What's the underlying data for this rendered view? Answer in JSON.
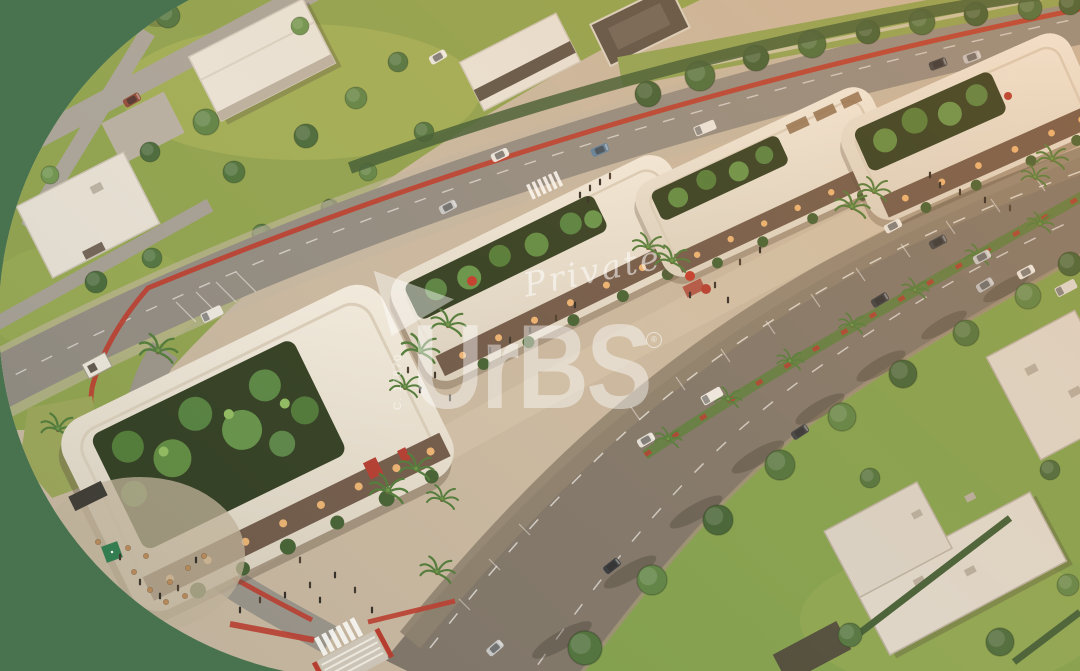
{
  "image_alt": "Aerial golden-hour 3D architectural rendering of an open-air retail strip with rooftop palm gardens and cafe terraces, flanked by tree-lined avenues with red bike lanes and a residential neighborhood, displayed inside a large rounded shape on a green background",
  "watermark": {
    "brand": "UrBS",
    "registered_mark": "®",
    "label_script": "Private",
    "reference_code": "C. 17870"
  },
  "colors": {
    "bg-green": "#48734E",
    "ground-tan": "#C7B7A2",
    "lawn-green": "#8DA24F",
    "lawn-warm": "#7FA04E",
    "road-gray": "#8F8A83",
    "avenue-gray": "#7D746A",
    "cobble-brown": "#8B7F6F",
    "median-green": "#5D7B43",
    "bike-lane-red": "#BA3A2E",
    "roof-white": "#EAE5DB",
    "garden-dark": "#2E3C22",
    "tree-green": "#4C713D",
    "hedge-dark": "#3C5B35",
    "glow-orange": "#EAB273",
    "watermark-white": "#FFFFFF"
  }
}
